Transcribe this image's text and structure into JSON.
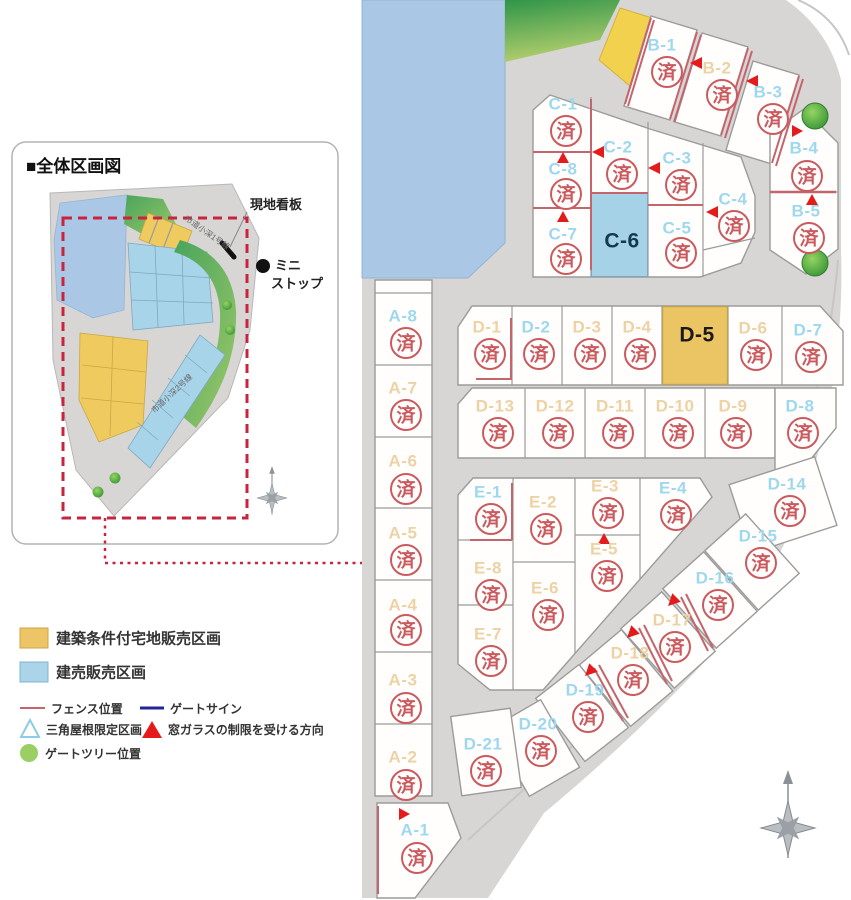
{
  "inset": {
    "title": "■全体区画図",
    "sign_label": "現地看板",
    "store_line1": "ミニ",
    "store_line2": "ストップ",
    "road1": "市道小深1号線",
    "road2": "市道小深2号線"
  },
  "legend": {
    "joken": "建築条件付宅地販売区画",
    "kenbai": "建売販売区画",
    "fence": "フェンス位置",
    "gate_sign": "ゲートサイン",
    "triangle_roof": "三角屋根限定区画",
    "window": "窓ガラスの制限を受ける方向",
    "gate_tree": "ゲートツリー位置"
  },
  "sold_stamp": "済",
  "colors": {
    "road_gray": "#d7d6d4",
    "water_blue": "#abc7e6",
    "joken_yellow": "#eec566",
    "kenbai_blue": "#a9d4ea",
    "label_blue": "#9ed8ee",
    "label_tan": "#ecd2a4",
    "stamp_red": "#ca5a5e",
    "fence_red": "#c4646c",
    "arrow_red": "#e31b1b",
    "gate_sign_navy": "#23239b",
    "tree_green": "#6abf4b",
    "dash_red": "#c9243f"
  },
  "lots": [
    {
      "id": "A-1",
      "label": "A-1",
      "type": "kenbai",
      "sold": true
    },
    {
      "id": "A-2",
      "label": "A-2",
      "type": "joken",
      "sold": true
    },
    {
      "id": "A-3",
      "label": "A-3",
      "type": "joken",
      "sold": true
    },
    {
      "id": "A-4",
      "label": "A-4",
      "type": "joken",
      "sold": true
    },
    {
      "id": "A-5",
      "label": "A-5",
      "type": "joken",
      "sold": true
    },
    {
      "id": "A-6",
      "label": "A-6",
      "type": "joken",
      "sold": true
    },
    {
      "id": "A-7",
      "label": "A-7",
      "type": "joken",
      "sold": true
    },
    {
      "id": "A-8",
      "label": "A-8",
      "type": "kenbai",
      "sold": true
    },
    {
      "id": "B-1",
      "label": "B-1",
      "type": "kenbai",
      "sold": true
    },
    {
      "id": "B-2",
      "label": "B-2",
      "type": "joken",
      "sold": true
    },
    {
      "id": "B-3",
      "label": "B-3",
      "type": "kenbai",
      "sold": true
    },
    {
      "id": "B-4",
      "label": "B-4",
      "type": "kenbai",
      "sold": true
    },
    {
      "id": "B-5",
      "label": "B-5",
      "type": "kenbai",
      "sold": true
    },
    {
      "id": "C-1",
      "label": "C-1",
      "type": "kenbai",
      "sold": true
    },
    {
      "id": "C-2",
      "label": "C-2",
      "type": "kenbai",
      "sold": true
    },
    {
      "id": "C-3",
      "label": "C-3",
      "type": "kenbai",
      "sold": true
    },
    {
      "id": "C-4",
      "label": "C-4",
      "type": "kenbai",
      "sold": true
    },
    {
      "id": "C-5",
      "label": "C-5",
      "type": "kenbai",
      "sold": true
    },
    {
      "id": "C-6",
      "label": "C-6",
      "type": "available-kenbai",
      "sold": false
    },
    {
      "id": "C-7",
      "label": "C-7",
      "type": "kenbai",
      "sold": true
    },
    {
      "id": "C-8",
      "label": "C-8",
      "type": "kenbai",
      "sold": true
    },
    {
      "id": "D-1",
      "label": "D-1",
      "type": "joken",
      "sold": true
    },
    {
      "id": "D-2",
      "label": "D-2",
      "type": "kenbai",
      "sold": true
    },
    {
      "id": "D-3",
      "label": "D-3",
      "type": "joken",
      "sold": true
    },
    {
      "id": "D-4",
      "label": "D-4",
      "type": "joken",
      "sold": true
    },
    {
      "id": "D-5",
      "label": "D-5",
      "type": "available-joken",
      "sold": false
    },
    {
      "id": "D-6",
      "label": "D-6",
      "type": "joken",
      "sold": true
    },
    {
      "id": "D-7",
      "label": "D-7",
      "type": "kenbai",
      "sold": true
    },
    {
      "id": "D-8",
      "label": "D-8",
      "type": "kenbai",
      "sold": true
    },
    {
      "id": "D-9",
      "label": "D-9",
      "type": "joken",
      "sold": true
    },
    {
      "id": "D-10",
      "label": "D-10",
      "type": "joken",
      "sold": true
    },
    {
      "id": "D-11",
      "label": "D-11",
      "type": "joken",
      "sold": true
    },
    {
      "id": "D-12",
      "label": "D-12",
      "type": "joken",
      "sold": true
    },
    {
      "id": "D-13",
      "label": "D-13",
      "type": "joken",
      "sold": true
    },
    {
      "id": "D-14",
      "label": "D-14",
      "type": "kenbai",
      "sold": true
    },
    {
      "id": "D-15",
      "label": "D-15",
      "type": "kenbai",
      "sold": true
    },
    {
      "id": "D-16",
      "label": "D-16",
      "type": "kenbai",
      "sold": true
    },
    {
      "id": "D-17",
      "label": "D-17",
      "type": "joken",
      "sold": true
    },
    {
      "id": "D-18",
      "label": "D-18",
      "type": "joken",
      "sold": true
    },
    {
      "id": "D-19",
      "label": "D-19",
      "type": "kenbai",
      "sold": true
    },
    {
      "id": "D-20",
      "label": "D-20",
      "type": "kenbai",
      "sold": true
    },
    {
      "id": "D-21",
      "label": "D-21",
      "type": "kenbai",
      "sold": true
    },
    {
      "id": "E-1",
      "label": "E-1",
      "type": "kenbai",
      "sold": true
    },
    {
      "id": "E-2",
      "label": "E-2",
      "type": "joken",
      "sold": true
    },
    {
      "id": "E-3",
      "label": "E-3",
      "type": "joken",
      "sold": true
    },
    {
      "id": "E-4",
      "label": "E-4",
      "type": "kenbai",
      "sold": true
    },
    {
      "id": "E-5",
      "label": "E-5",
      "type": "joken",
      "sold": true
    },
    {
      "id": "E-6",
      "label": "E-6",
      "type": "joken",
      "sold": true
    },
    {
      "id": "E-7",
      "label": "E-7",
      "type": "joken",
      "sold": true
    },
    {
      "id": "E-8",
      "label": "E-8",
      "type": "joken",
      "sold": true
    }
  ]
}
